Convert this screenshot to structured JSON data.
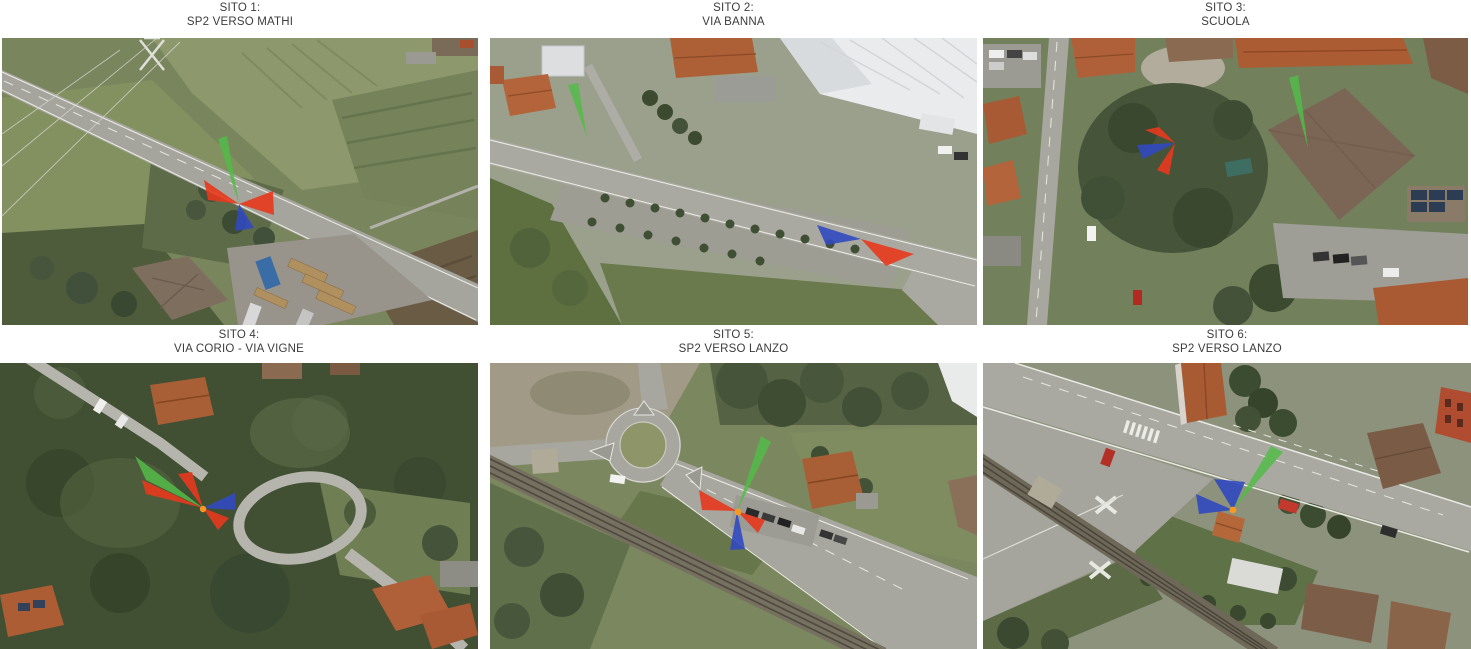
{
  "page": {
    "background": "#ffffff",
    "text_color": "#3c3c3c"
  },
  "sites": [
    {
      "number": "SITO 1:",
      "location": "SP2 VERSO MATHI"
    },
    {
      "number": "SITO 2:",
      "location": "VIA BANNA"
    },
    {
      "number": "SITO 3:",
      "location": "SCUOLA"
    },
    {
      "number": "SITO 4:",
      "location": "VIA CORIO - VIA VIGNE"
    },
    {
      "number": "SITO 5:",
      "location": "SP2 VERSO LANZO"
    },
    {
      "number": "SITO 6:",
      "location": "SP2 VERSO LANZO"
    }
  ],
  "marker_colors": {
    "red_sector": "#e8391d",
    "blue_sector": "#3149c0",
    "green_beam": "#53bb49",
    "orange_point": "#f59a23"
  }
}
